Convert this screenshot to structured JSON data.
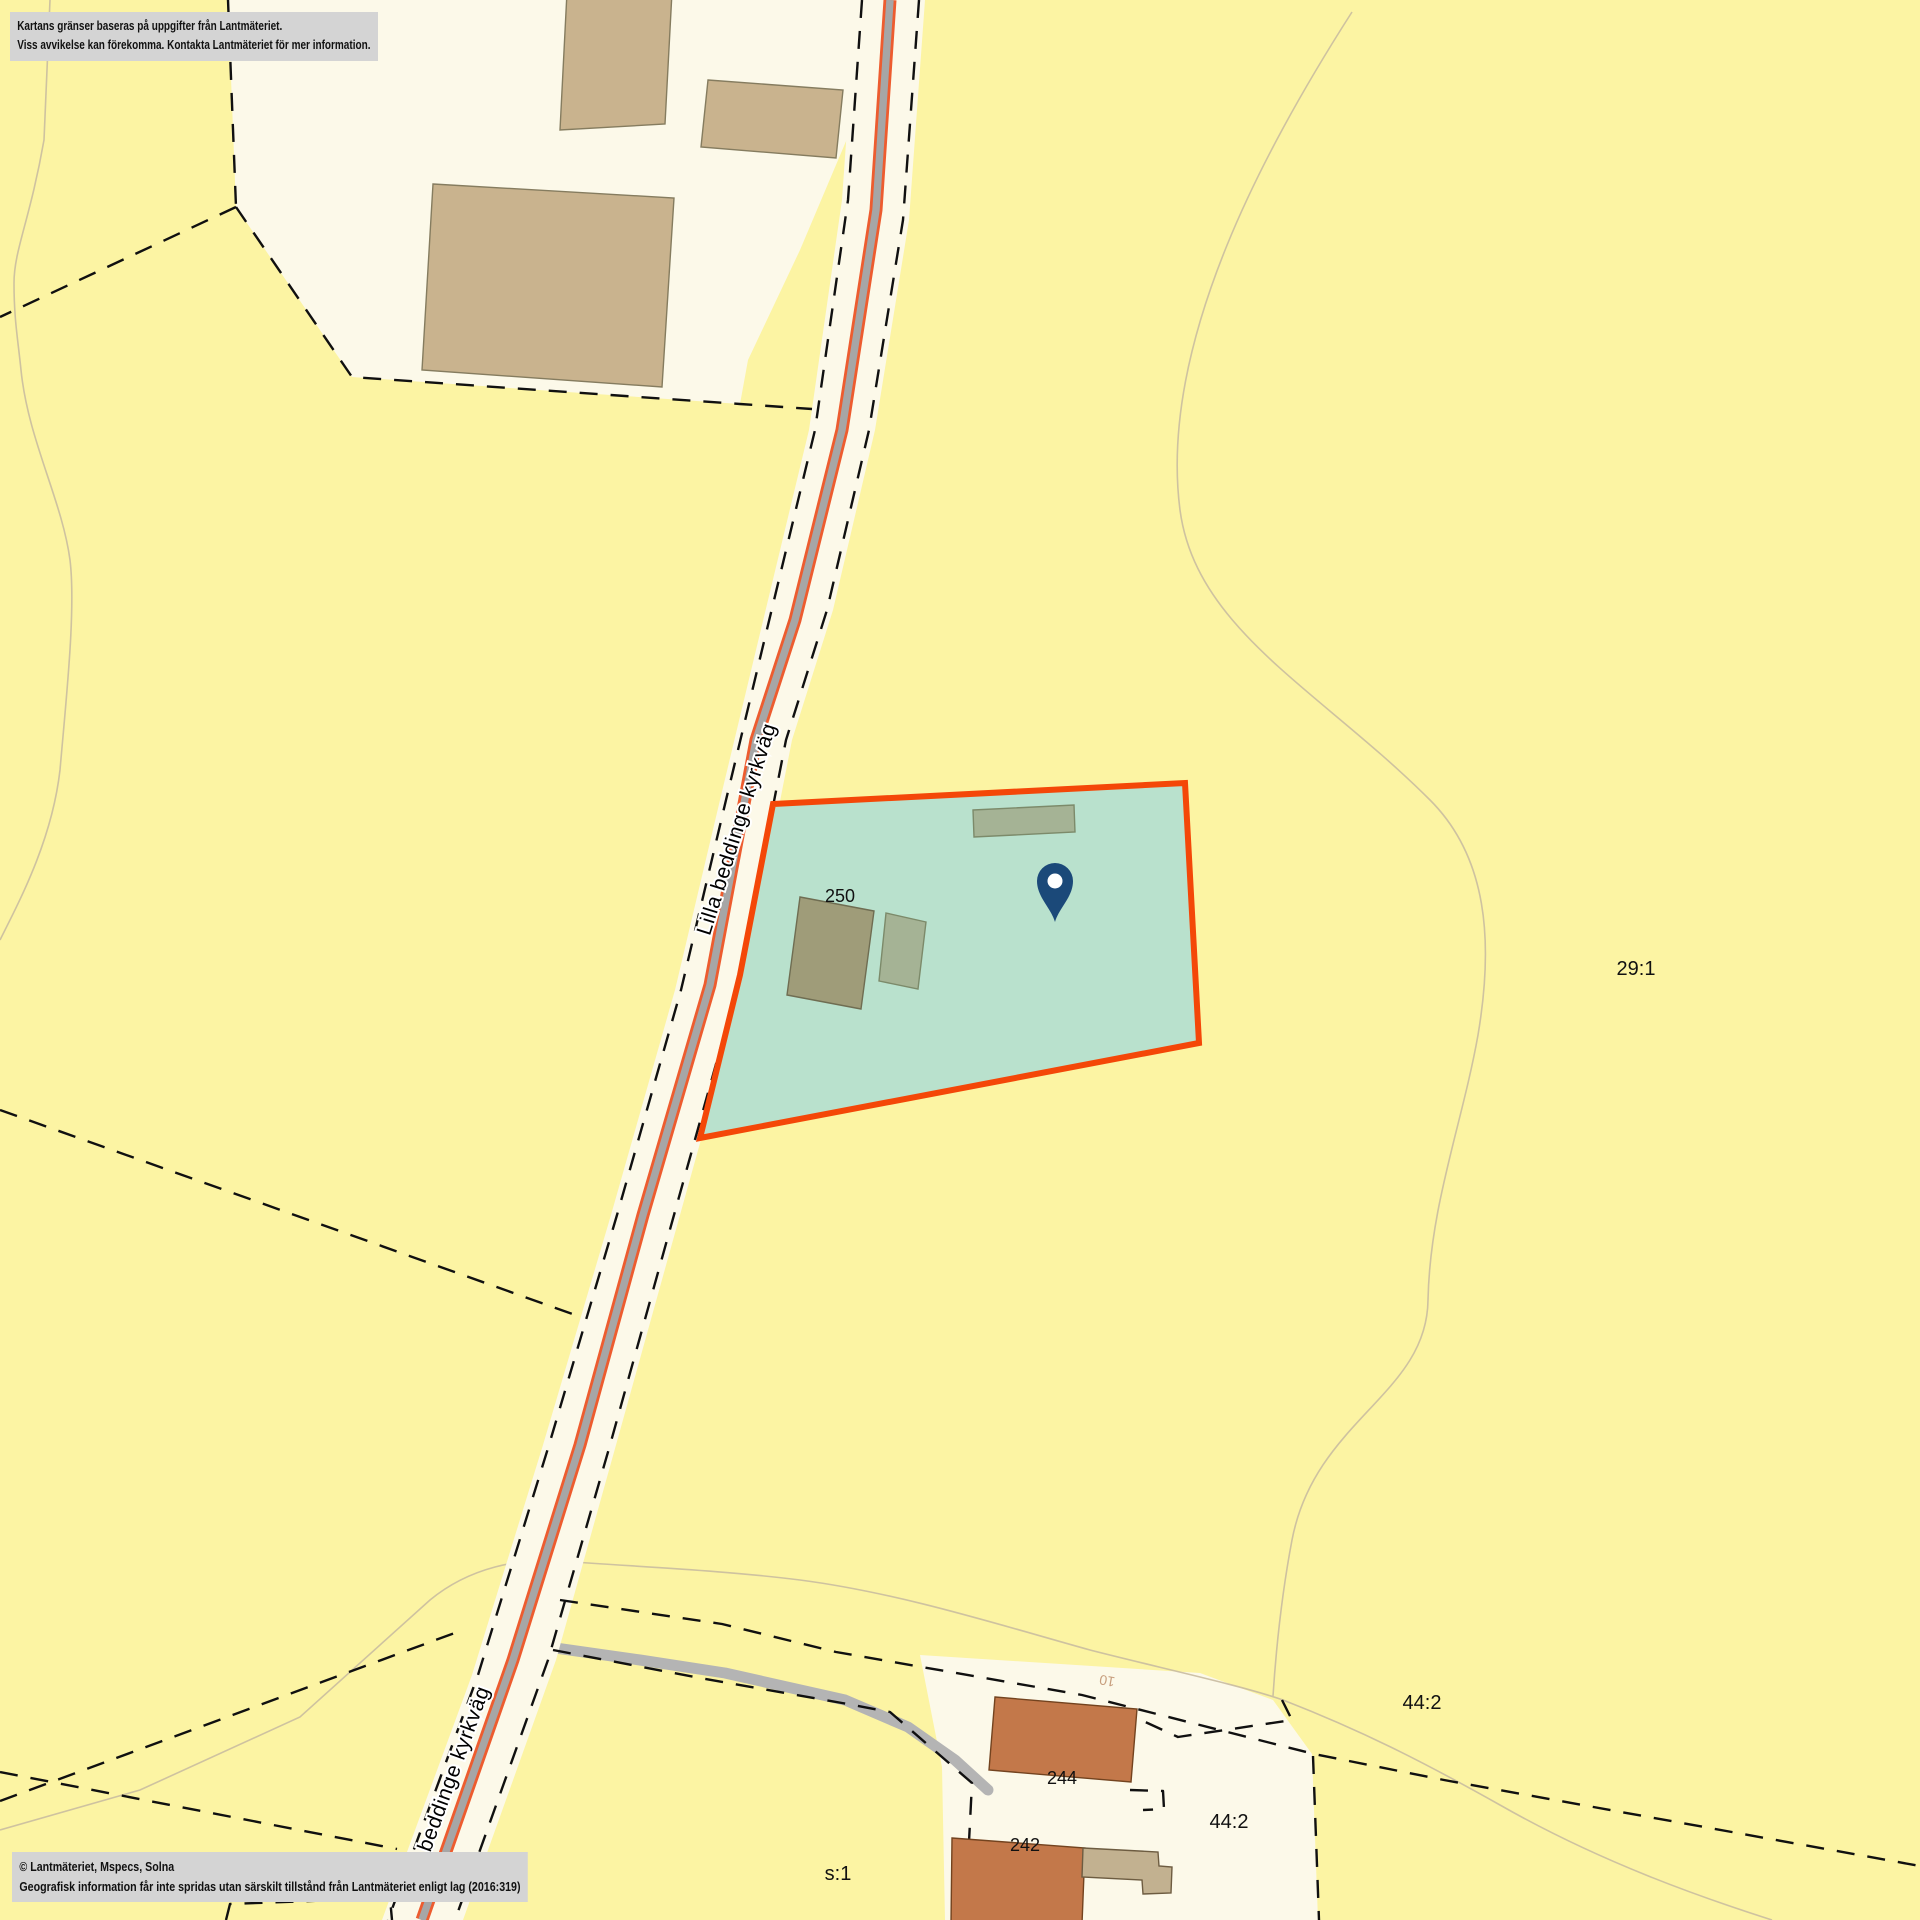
{
  "map": {
    "labels": {
      "road_name": "Lilla beddinge kyrkväg",
      "road_name_bottom": "Lilla beddinge kyrkväg",
      "parcel_29_1": "29:1",
      "parcel_44_2_upper": "44:2",
      "parcel_44_2_lower": "44:2",
      "parcel_s_1": "s:1",
      "address_250": "250",
      "address_244": "244",
      "address_242": "242",
      "road_10": "10"
    },
    "marker": {
      "icon": "location-pin"
    },
    "colors": {
      "background": "#fcf4a3",
      "parcel_cream": "#fcf9e9",
      "highlight_fill": "#b9e1cd",
      "highlight_border": "#f44708",
      "road_gray": "#a6a6a6",
      "road_edge_orange": "#ed5c2f",
      "side_road_gray": "#b4b4b4",
      "boundary_dash": "#101010",
      "contour": "#c9bca0",
      "building_tan": "#c9b38e",
      "building_olive": "#9f9c79",
      "building_green": "#a5b395",
      "building_orange": "#c3784a",
      "building_light_tan": "#c2b190",
      "marker_blue": "#1b4979",
      "notice_bg": "#d4d4d4",
      "label_gray_green": "#5f6f5f",
      "label_tan": "#c79e7d"
    },
    "notice": {
      "line1": "Kartans gränser baseras på uppgifter från Lantmäteriet.",
      "line2": "Viss avvikelse kan förekomma. Kontakta Lantmäteriet för mer information."
    },
    "copyright": {
      "line1": "© Lantmäteriet, Mspecs, Solna",
      "line2": "Geografisk information får inte spridas utan särskilt tillstånd från Lantmäteriet enligt lag (2016:319)"
    }
  }
}
